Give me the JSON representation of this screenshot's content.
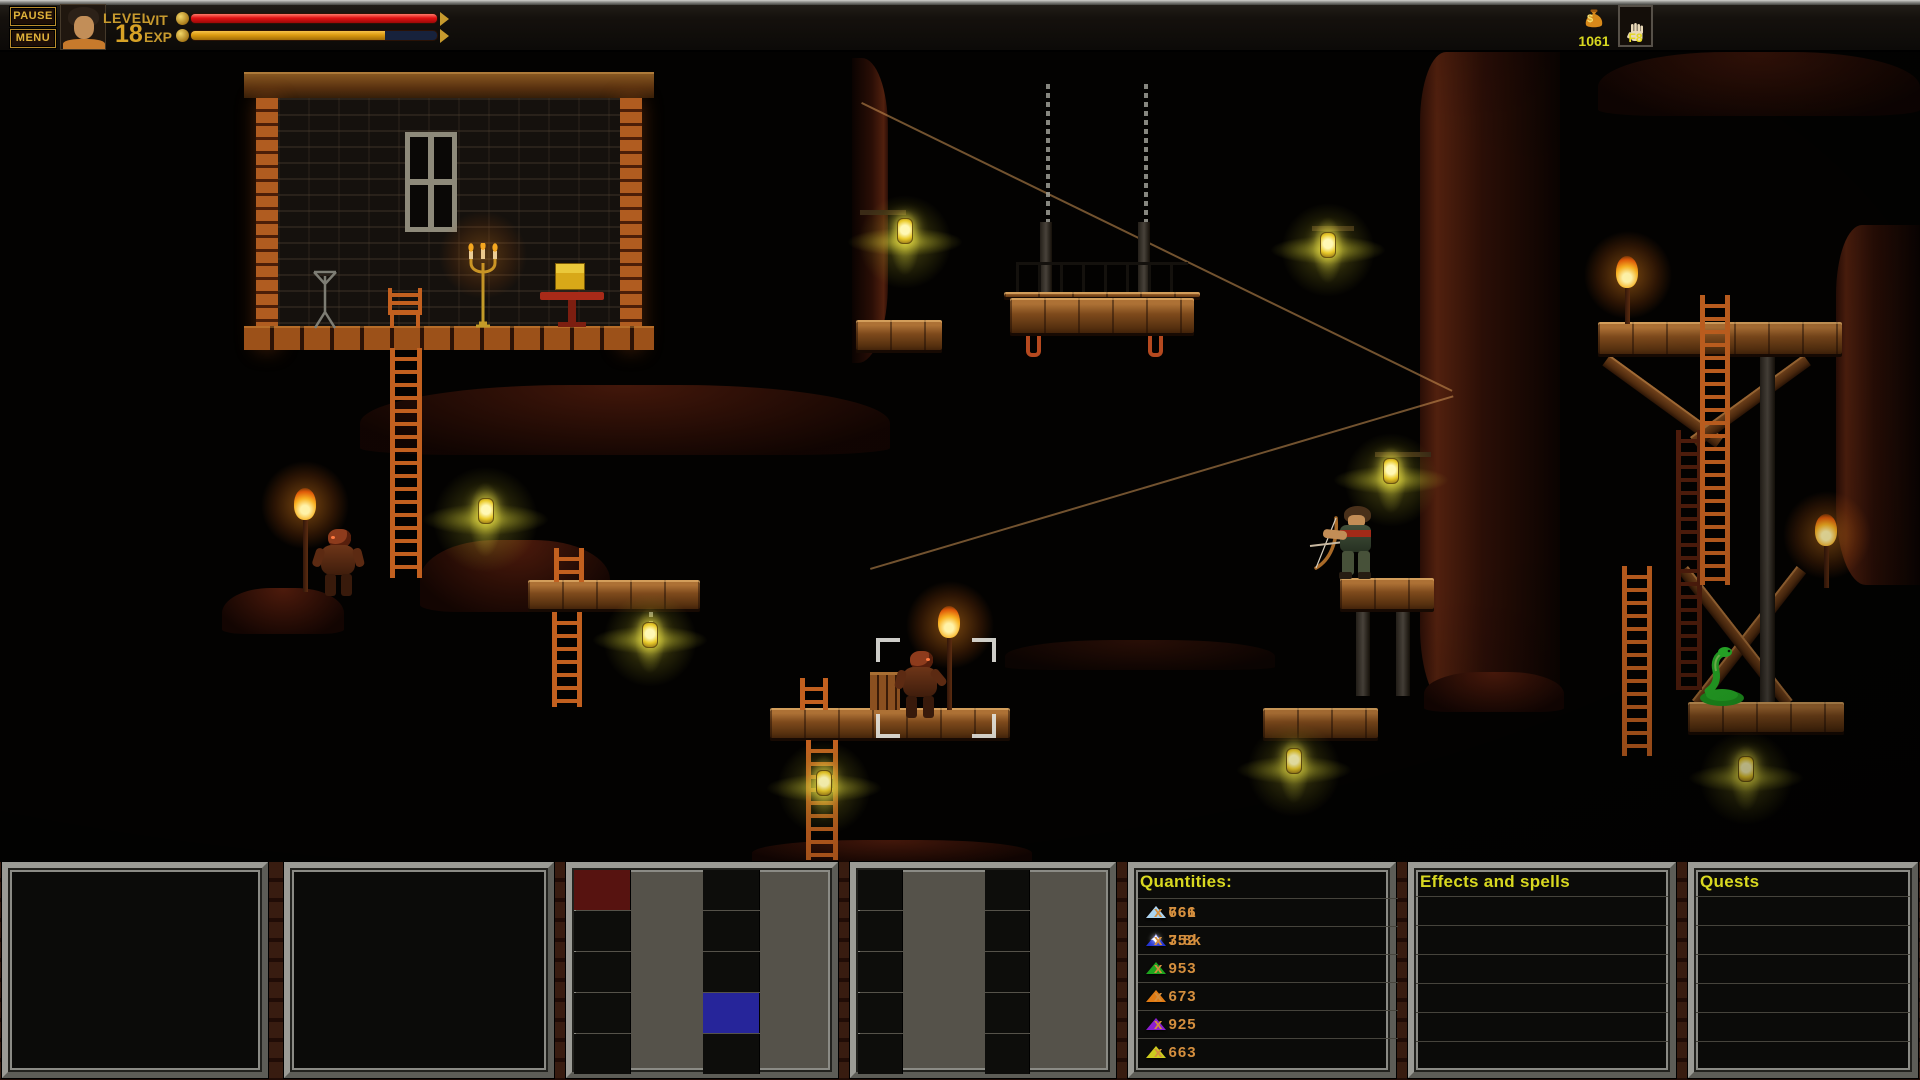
{
  "hud": {
    "pause_label": "PAUSE",
    "menu_label": "MENU",
    "level_label": "LEVEL",
    "level_value": "18",
    "vit_label": "VIT",
    "exp_label": "EXP",
    "vit_fill_style": "width:100%",
    "exp_fill_style": "width:79%",
    "gold_amount": "1061",
    "gold_symbol": "$",
    "fkeys": [
      {
        "label": "F1",
        "icon": "empty"
      },
      {
        "label": "F2",
        "icon": "sword",
        "selected": true
      },
      {
        "label": "F3",
        "icon": "potion"
      },
      {
        "label": "F4",
        "icon": "scroll"
      },
      {
        "label": "F5",
        "icon": "book"
      },
      {
        "label": "F6",
        "icon": "compass"
      },
      {
        "label": "F7",
        "icon": "paw"
      },
      {
        "label": "F8",
        "icon": "hand"
      }
    ],
    "colors": {
      "accent_gold": "#d9a92c",
      "vit_bar": "#e01212",
      "exp_bar": "#dc9a10",
      "selected_slot_border": "#e8c820",
      "hud_yellow_text": "#d8d820"
    }
  },
  "hotbar1": {
    "slots": [
      {
        "key": "1",
        "name": "polimorf",
        "count": "x 8",
        "icon": "wand"
      },
      {
        "key": "2",
        "dmg_label": "dmg",
        "dmg": "45",
        "icon": "axe"
      },
      {
        "key": "3",
        "dmg_label": "dmg",
        "dmg": "160",
        "icon": "spear"
      },
      {
        "key": "4",
        "dmg_label": "dmg",
        "dmg": "240",
        "icon": "mace"
      },
      {
        "key": "5",
        "dmg_label": "dmg",
        "dmg": "280",
        "icon": "hammer"
      },
      {
        "key": "6",
        "dmg_label": "dmg",
        "dmg": "160",
        "icon": "dart"
      },
      {
        "key": "7",
        "dmg_label": "dmg",
        "dmg": "260",
        "icon": "battle-axe"
      },
      {
        "key": "8",
        "dmg_label": "dmg",
        "dmg": "70",
        "count": "x 4.4k",
        "icon": "bow"
      },
      {
        "key": "9",
        "dmg_label": "dmg",
        "dmg": "150",
        "count": "x 677",
        "icon": "bow-arrow"
      },
      {
        "key": "0"
      }
    ]
  },
  "hotbar2": {
    "modifier_arrow": "↑",
    "slots": [
      {
        "key": "1"
      },
      {
        "key": "2"
      },
      {
        "key": "3"
      },
      {
        "key": "4"
      },
      {
        "key": "5"
      },
      {
        "key": "6"
      },
      {
        "key": "7"
      },
      {
        "key": "8"
      },
      {
        "key": "9"
      },
      {
        "key": "0"
      }
    ]
  },
  "quantities": {
    "title": "Quantities:",
    "entries": [
      {
        "icon": "red-triangle",
        "color": "#d42a1a",
        "value": "x 761"
      },
      {
        "icon": "lightblue-triangle",
        "color": "#a8d4f0",
        "value": "x 666"
      },
      {
        "icon": "blue-triangle",
        "color": "#2334d4",
        "value": "x 752"
      },
      {
        "icon": "white-star",
        "color": "#f2f2f2",
        "value": "x 3.8k"
      },
      {
        "icon": "green-triangle",
        "color": "#1ea41e",
        "value": "x 953"
      },
      {
        "icon": "orange-triangle",
        "color": "#e27c14",
        "value": "x 673"
      },
      {
        "icon": "purple-triangle",
        "color": "#8c1ed2",
        "value": "x 925"
      },
      {
        "icon": "yellow-triangle",
        "color": "#cccc1e",
        "value": "x 663"
      }
    ]
  },
  "effects_panel": {
    "title": "Effects and spells"
  },
  "quests_panel": {
    "title": "Quests"
  }
}
